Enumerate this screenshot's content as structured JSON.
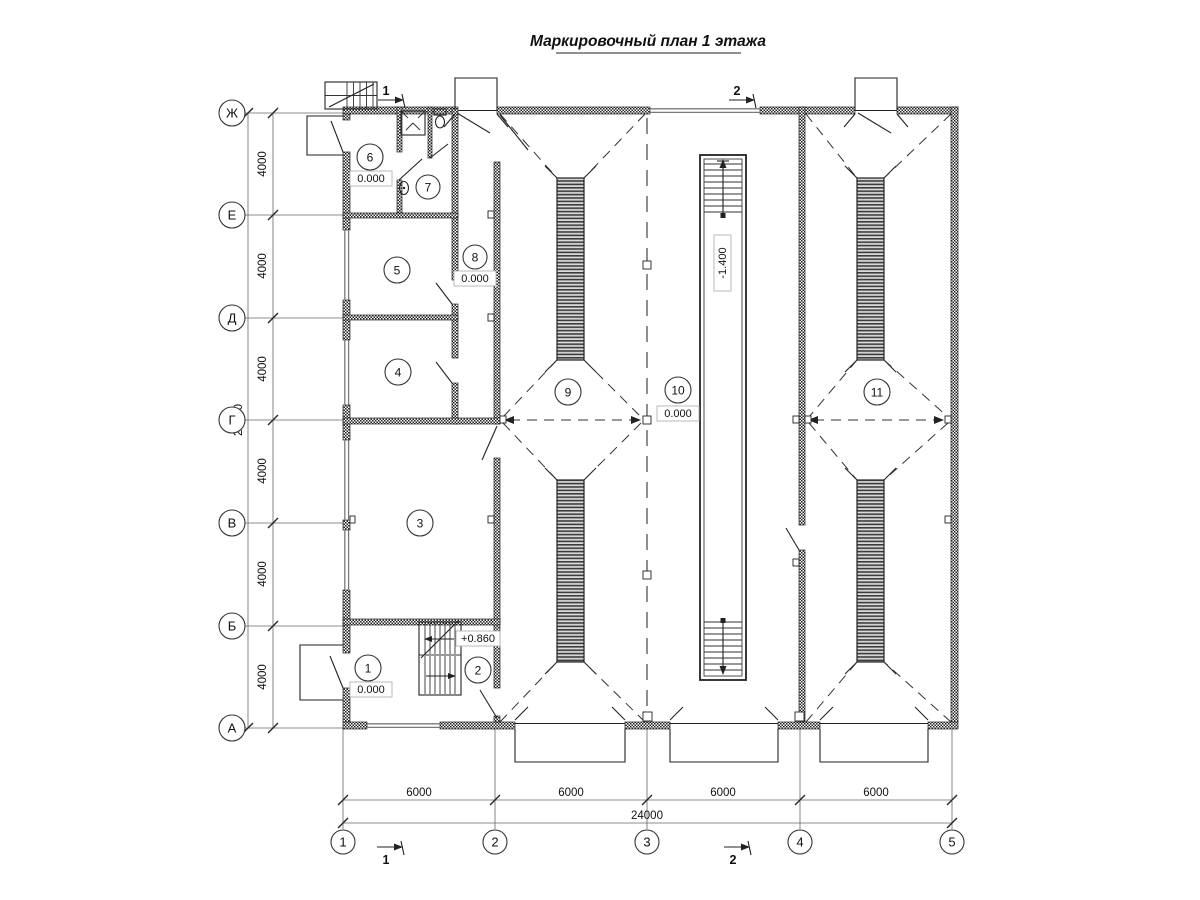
{
  "title": "Маркировочный план 1 этажа",
  "axes": {
    "rows": [
      "Ж",
      "Е",
      "Д",
      "Г",
      "В",
      "Б",
      "А"
    ],
    "cols": [
      "1",
      "2",
      "3",
      "4",
      "5"
    ]
  },
  "dims": {
    "v_seg": "4000",
    "v_total": "24000",
    "h_seg": "6000",
    "h_total": "24000"
  },
  "rooms": [
    "1",
    "2",
    "3",
    "4",
    "5",
    "6",
    "7",
    "8",
    "9",
    "10",
    "11"
  ],
  "elevations": {
    "ground": "0.000",
    "landing": "+0.860",
    "pit": "-1.400"
  },
  "sections": {
    "s1": "1",
    "s2": "2"
  }
}
